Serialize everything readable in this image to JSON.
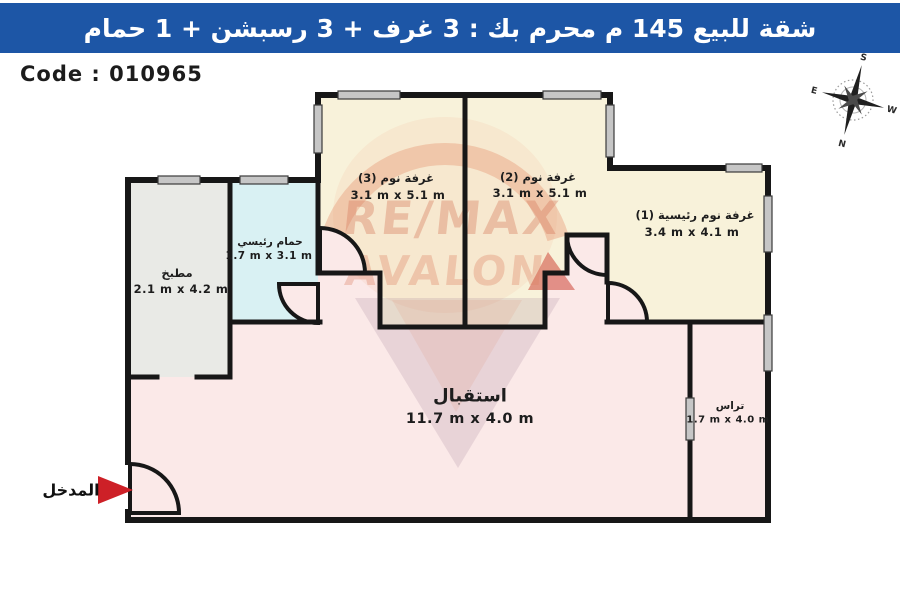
{
  "header": {
    "title": "شقة للبيع 145 م محرم بك :  3 غرف + 3 رسبشن + 1 حمام"
  },
  "code_label": "Code : 010965",
  "entrance_label": "المدخل",
  "watermark": {
    "line1": "RE/MAX",
    "line2": "AVALON"
  },
  "compass": {
    "north": "N",
    "south": "S",
    "east": "E",
    "west": "W"
  },
  "rooms": {
    "bedroom3": {
      "name": "غرفة نوم (3)",
      "dims": "3.1 m x 5.1 m"
    },
    "bedroom2": {
      "name": "غرفة نوم (2)",
      "dims": "3.1 m x 5.1 m"
    },
    "master": {
      "name": "غرفة نوم رئيسية (1)",
      "dims": "3.4 m x 4.1 m"
    },
    "bathroom": {
      "name": "حمام رئيسي",
      "dims": "1.7 m x 3.1 m"
    },
    "kitchen": {
      "name": "مطبخ",
      "dims": "2.1 m x 4.2 m"
    },
    "reception": {
      "name": "استقبال",
      "dims": "11.7 m x 4.0 m"
    },
    "terrace": {
      "name": "تراس",
      "dims": "1.7 m x 4.0 m"
    }
  },
  "colors": {
    "header_bg": "#1d56a6",
    "cream": "#f8f2da",
    "gray": "#e9eae6",
    "cyan": "#d9f1f3",
    "pink": "#fbe9e8",
    "wall": "#171717",
    "red": "#cd2027",
    "window": "#c6c6c6"
  }
}
